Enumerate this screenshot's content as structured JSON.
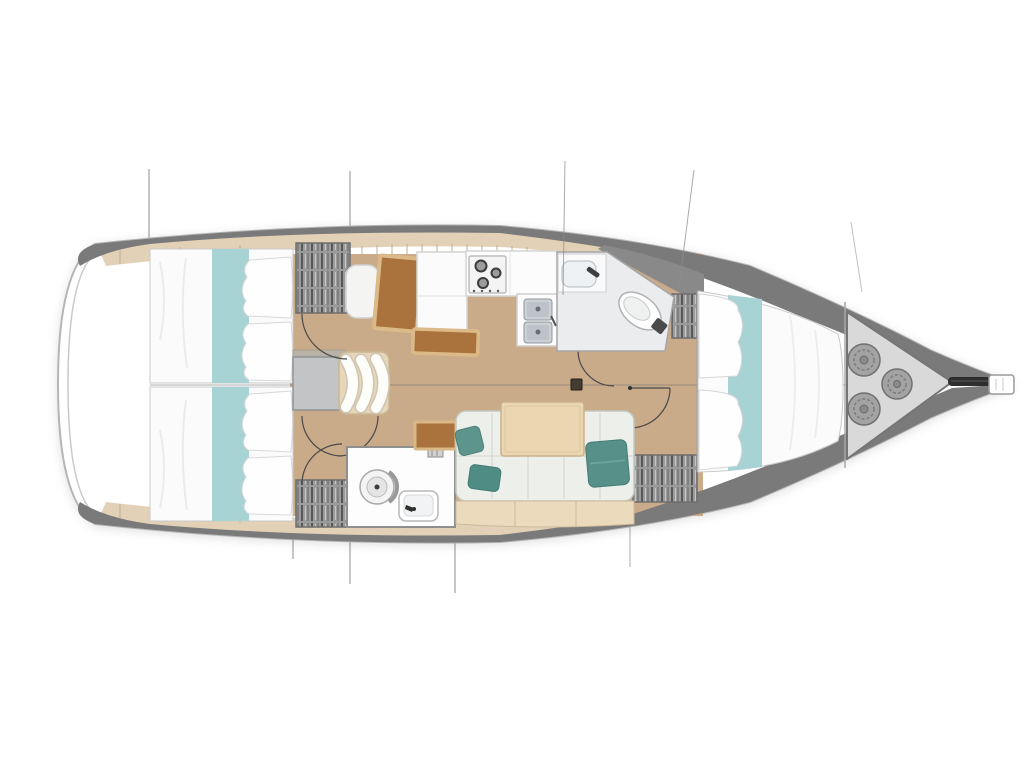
{
  "diagram": {
    "kind": "yacht-interior-floor-plan",
    "orientation": "bow-right",
    "rooms": [
      {
        "name": "aft-cabin-port"
      },
      {
        "name": "aft-cabin-starboard"
      },
      {
        "name": "companionway-steps"
      },
      {
        "name": "nav-station"
      },
      {
        "name": "galley"
      },
      {
        "name": "head-forward-top"
      },
      {
        "name": "head-aft-bottom"
      },
      {
        "name": "saloon"
      },
      {
        "name": "forward-cabin"
      },
      {
        "name": "sail-locker"
      }
    ]
  },
  "colors": {
    "background": "#ffffff",
    "deck_band": "#7a7a7a",
    "hull_outline": "#b5b5b5",
    "wood_floor": "#c9aa89",
    "shelf_tan": "#e2d1b6",
    "bed_linen": "#fbfbfb",
    "bed_runner_teal": "#a8d3d5",
    "pillow_teal": "#4f8d84",
    "pillow_teal_2": "#579089",
    "pillow_teal_3": "#5d948b",
    "sofa_cushion": "#edefeb",
    "sofa_base": "#ecdabc",
    "table_wood": "#ead6b0",
    "desk_brown": "#aa723d",
    "desk_border": "#dcba87",
    "wardrobe_gray": "#9b9b9b",
    "head_floor": "#eaecee",
    "companionway_pad": "#c2c4c6",
    "steps_casing": "#e7d6b9",
    "sail_locker_floor": "#d9d9d9",
    "rope_coil": "#a3a3a3",
    "hardware_dark": "#2e2e2e"
  }
}
